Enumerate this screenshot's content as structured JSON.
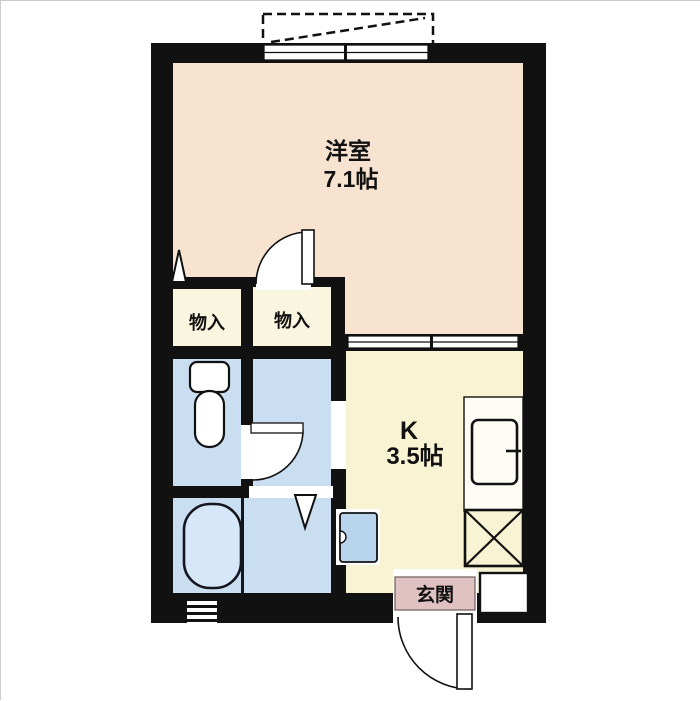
{
  "floorplan": {
    "type": "japanese-apartment-floor-plan",
    "rooms": {
      "western_room": {
        "label": "洋室",
        "size": "7.1帖"
      },
      "kitchen": {
        "label": "K",
        "size": "3.5帖"
      },
      "entrance": {
        "label": "玄関"
      }
    },
    "closets": [
      {
        "label": "物入"
      },
      {
        "label": "物入"
      }
    ],
    "fixtures": [
      "toilet",
      "bathtub",
      "kitchen-sink-counter",
      "refrigerator-space-x",
      "washing-machine-pan",
      "entrance-swing-door",
      "room-swing-door",
      "washroom-swing-door",
      "sliding-door",
      "window",
      "balcony-outline",
      "vent-louver"
    ],
    "colors": {
      "wall": "#111111",
      "western_room": "#f8e3d0",
      "kitchen": "#f7f3d3",
      "closet": "#faf5df",
      "wet_area": "#cadef2",
      "entrance": "#e0c2c2",
      "fixture_white": "#ffffff"
    }
  }
}
